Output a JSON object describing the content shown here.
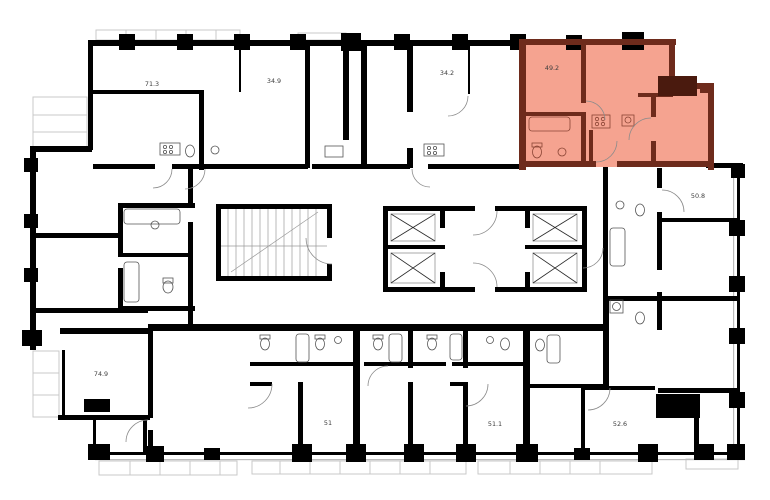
{
  "plan": {
    "type": "residential-floor-plan",
    "colors": {
      "background": "#ffffff",
      "wall": "#000000",
      "secondary_line": "#bbbbbb",
      "light_line": "#c9c9c9",
      "stair_line": "#9a9a9a",
      "fixture_line": "#555555",
      "arc_line": "#8b8b8b",
      "elevator_inner": "#aaaaaa",
      "highlight_fill": "#f5a390",
      "highlight_wall": "#6e2b1c",
      "highlight_column": "#4a1a0e",
      "highlight_fixture_line": "#8a4434",
      "label_text": "#3c3c3c"
    },
    "units": [
      {
        "name": "unit-71-3",
        "area_label": "71.3",
        "highlighted": false
      },
      {
        "name": "unit-34-9",
        "area_label": "34.9",
        "highlighted": false
      },
      {
        "name": "unit-34-2",
        "area_label": "34.2",
        "highlighted": false
      },
      {
        "name": "unit-49-2",
        "area_label": "49.2",
        "highlighted": true
      },
      {
        "name": "unit-50-8",
        "area_label": "50.8",
        "highlighted": false
      },
      {
        "name": "unit-74-9",
        "area_label": "74.9",
        "highlighted": false
      },
      {
        "name": "unit-51",
        "area_label": "51",
        "highlighted": false
      },
      {
        "name": "unit-51-1",
        "area_label": "51.1",
        "highlighted": false
      },
      {
        "name": "unit-52-6",
        "area_label": "52.6",
        "highlighted": false
      }
    ]
  }
}
